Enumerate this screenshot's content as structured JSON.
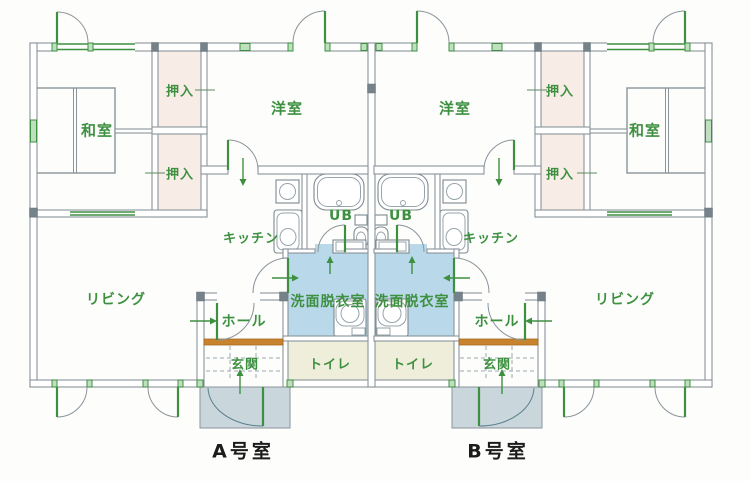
{
  "plan": {
    "title_implicit": "二戸一住宅平面図",
    "room_labels": {
      "washitsu": "和室",
      "oshiire": "押入",
      "yoshitsu": "洋室",
      "kitchen": "キッチン",
      "unit_bath": "UB",
      "living": "リビング",
      "washroom": "洗面脱衣室",
      "hall": "ホール",
      "toilet": "トイレ",
      "genkan": "玄関"
    },
    "unit_a_label": "A号室",
    "unit_b_label": "B号室",
    "colors": {
      "label_green": "#3e9041",
      "closet_pink": "#f8ece6",
      "washroom_blue": "#b9d8ea",
      "toilet_cream": "#efeeda",
      "porch_gray": "#c9d6dc",
      "kamachi_orange": "#c8832f",
      "wall_line": "#8a949b",
      "unit_text": "#1c1c1c"
    }
  }
}
